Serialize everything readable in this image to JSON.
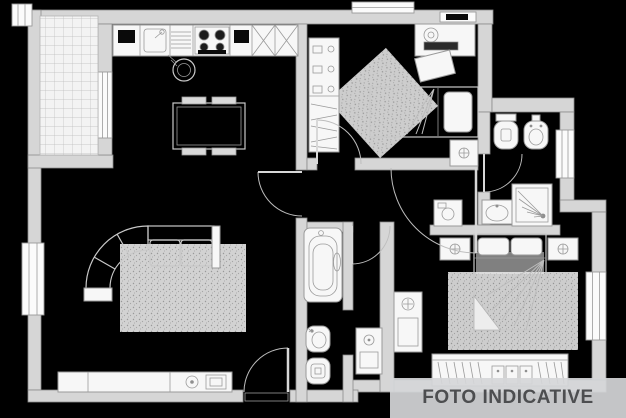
{
  "watermark": {
    "label": "FOTO INDICATIVE"
  },
  "theme": {
    "bg": "#000000",
    "wall_fill": "#d6d6d6",
    "wall_stroke": "#8a8a8a",
    "line": "#c9c9c9",
    "furn_stroke": "#9a9a9a",
    "furn_fill": "#f7f7f7",
    "dark": "#0a0a0a",
    "banner_bg": "rgba(213,214,216,0.92)",
    "banner_text": "#4d4e50"
  },
  "floorplan": {
    "type": "apartment-floor-plan",
    "rooms": [
      {
        "name": "balcony",
        "features": [
          "tiled-floor",
          "door-to-living-area",
          "corner-window"
        ]
      },
      {
        "name": "kitchen-living-room",
        "furniture": [
          "kitchen-counter",
          "sink",
          "drainer",
          "stove",
          "corner-cabinets",
          "pot",
          "dining-table",
          "four-chairs",
          "corner-sofa",
          "rug",
          "tv-sideboard",
          "left-window",
          "entrance-door"
        ]
      },
      {
        "name": "bedroom-small",
        "furniture": [
          "shelving-unit",
          "desk",
          "desk-chair",
          "single-bed",
          "nightstand",
          "diagonal-rug"
        ]
      },
      {
        "name": "bathroom-top",
        "furniture": [
          "toilet",
          "bidet",
          "shower",
          "washbasin",
          "window",
          "washing-machine"
        ]
      },
      {
        "name": "bathroom-bottom",
        "furniture": [
          "bathtub",
          "bidet",
          "toilet"
        ]
      },
      {
        "name": "laundry-nook",
        "furniture": [
          "washbasin"
        ]
      },
      {
        "name": "master-bedroom",
        "furniture": [
          "double-bed",
          "nightstand-left",
          "nightstand-right",
          "rug",
          "wardrobe",
          "basin-cabinet",
          "window"
        ]
      }
    ]
  }
}
